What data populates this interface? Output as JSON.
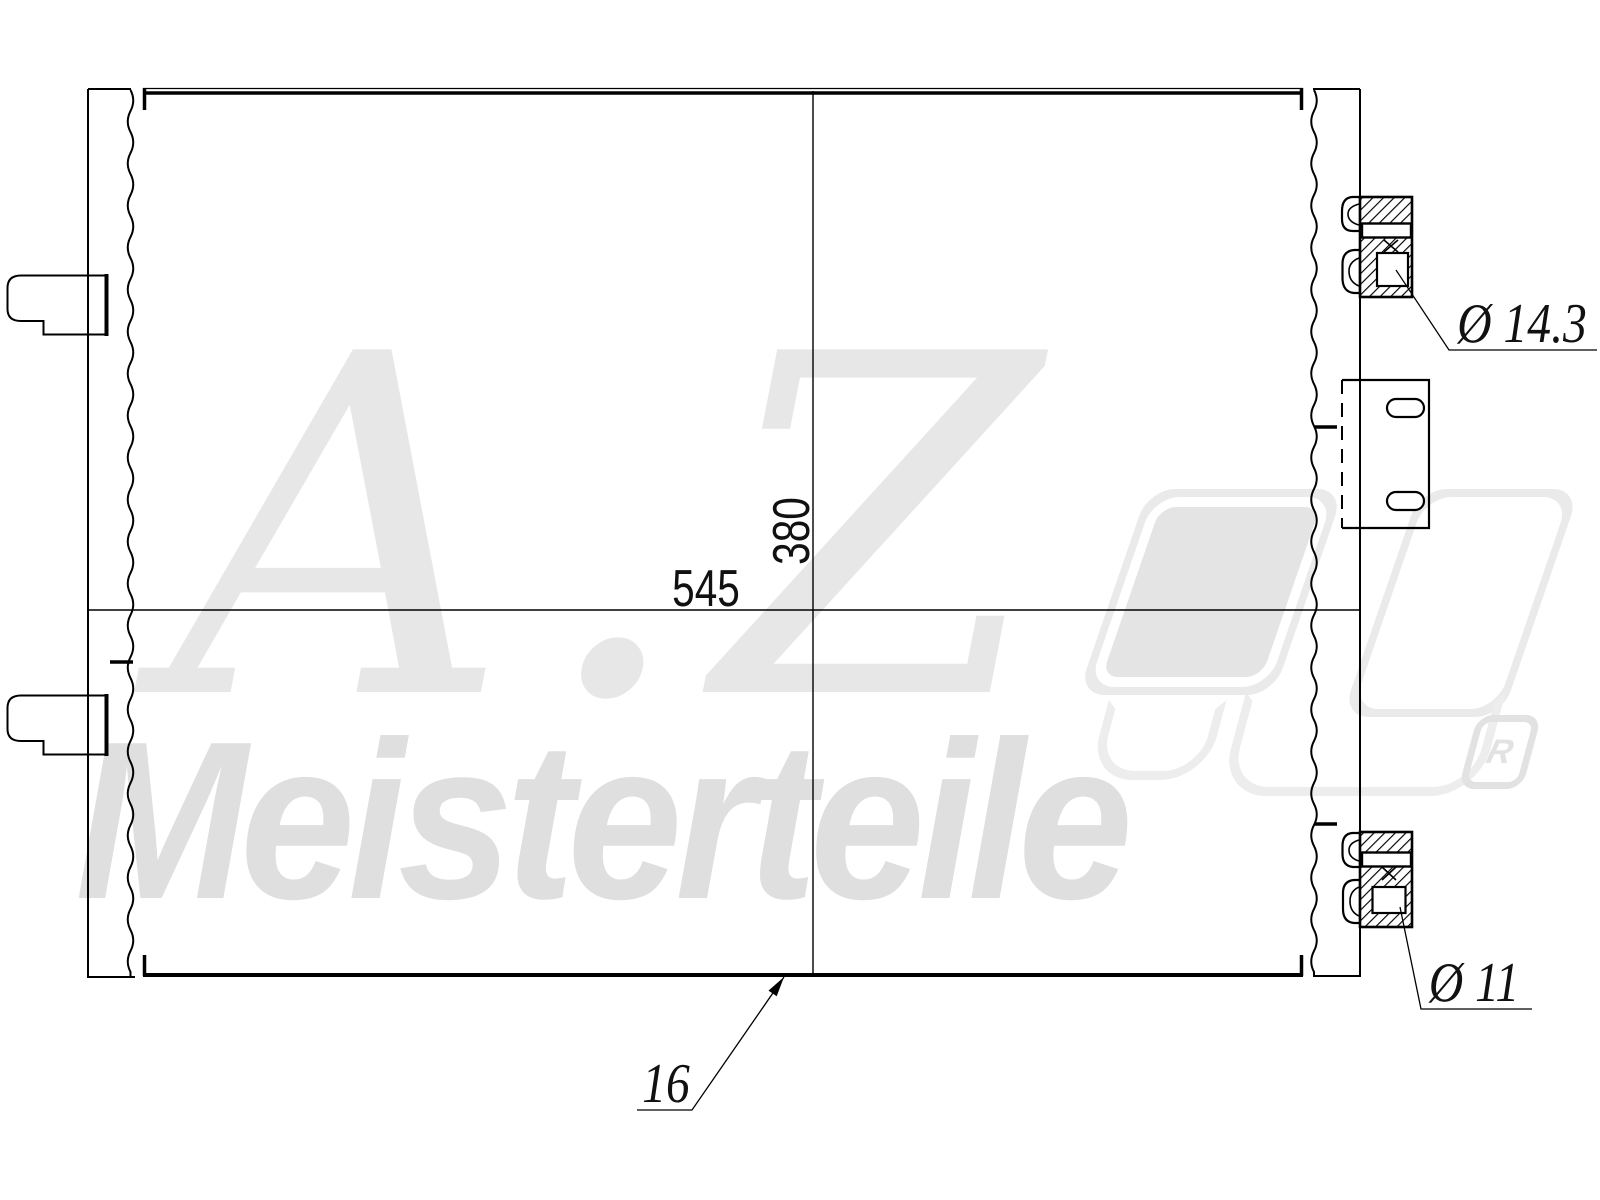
{
  "technical_drawing": {
    "type": "condenser-outline-drawing",
    "dimension_labels": {
      "core_width": "545",
      "core_height": "380",
      "depth": "16",
      "top_fitting_diameter": "Ø 14.3",
      "bottom_fitting_diameter": "Ø 11"
    },
    "colors": {
      "line": "#000000",
      "background": "#ffffff",
      "watermark_script": "#e7e7e7",
      "watermark_name": "#dfdfdf",
      "watermark_logo": "#eaeaea"
    }
  },
  "watermark": {
    "script": "A.Z.",
    "name": "Meisterteile",
    "registered_symbol": "R"
  }
}
